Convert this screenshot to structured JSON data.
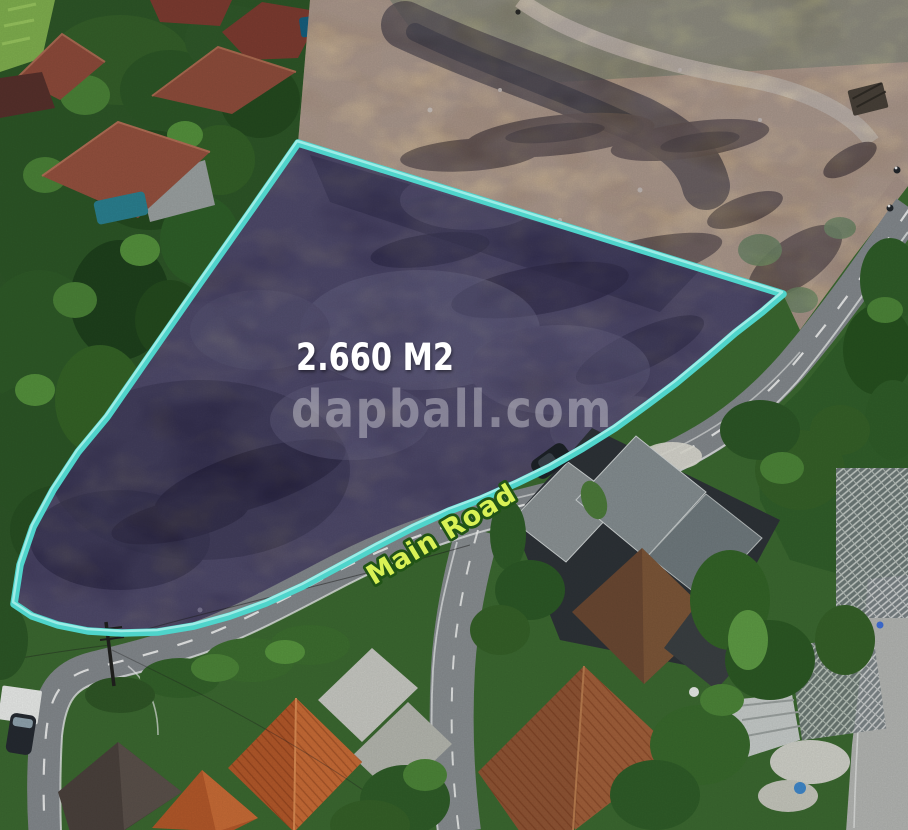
{
  "annotations": {
    "area_label": "2.660 M2",
    "watermark": "dapball.com",
    "road_label": "Main Road"
  },
  "colors": {
    "boundary": "#4fd4cb",
    "boundary-light": "#a9f1ec",
    "area-text": "#ffffff",
    "road-label-fill": "#d9f155",
    "road-label-stroke": "#215316",
    "watermark": "rgba(255,255,255,0.34)"
  }
}
